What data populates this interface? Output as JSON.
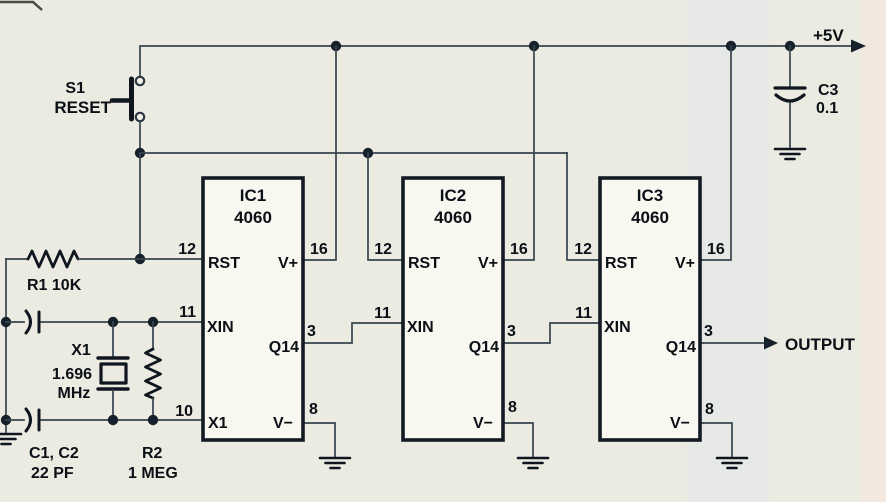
{
  "colors": {
    "paper": "#ECEBE2",
    "wire": "#37434E",
    "ink": "#10161F",
    "text": "#0B1016",
    "ic_fill": "#F8F7F0",
    "scan_band": "#E4E8E6",
    "page_edge_strip": "#F5E7DE"
  },
  "power_rail": {
    "label": "+5V"
  },
  "reset_switch": {
    "ref": "S1",
    "label": "RESET"
  },
  "r1": {
    "label": "R1 10K"
  },
  "crystal_x1": {
    "ref": "X1",
    "freq": "1.696",
    "unit": "MHz"
  },
  "c1_c2": {
    "refs": "C1, C2",
    "value": "22 PF"
  },
  "r2": {
    "ref": "R2",
    "value": "1 MEG"
  },
  "c3": {
    "ref": "C3",
    "value": "0.1"
  },
  "output": {
    "label": "OUTPUT"
  },
  "ics": [
    {
      "ref": "IC1",
      "part": "4060",
      "pins": {
        "rst_num": "12",
        "rst_name": "RST",
        "xin_num": "11",
        "xin_name": "XIN",
        "x1_num": "10",
        "x1_name": "X1",
        "vplus_num": "16",
        "vplus_name": "V+",
        "q14_num": "3",
        "q14_name": "Q14",
        "vminus_num": "8",
        "vminus_name": "V−"
      }
    },
    {
      "ref": "IC2",
      "part": "4060",
      "pins": {
        "rst_num": "12",
        "rst_name": "RST",
        "xin_num": "11",
        "xin_name": "XIN",
        "vplus_num": "16",
        "vplus_name": "V+",
        "q14_num": "3",
        "q14_name": "Q14",
        "vminus_num": "8",
        "vminus_name": "V−"
      }
    },
    {
      "ref": "IC3",
      "part": "4060",
      "pins": {
        "rst_num": "12",
        "rst_name": "RST",
        "xin_num": "11",
        "xin_name": "XIN",
        "vplus_num": "16",
        "vplus_name": "V+",
        "q14_num": "3",
        "q14_name": "Q14",
        "vminus_num": "8",
        "vminus_name": "V−"
      }
    }
  ]
}
